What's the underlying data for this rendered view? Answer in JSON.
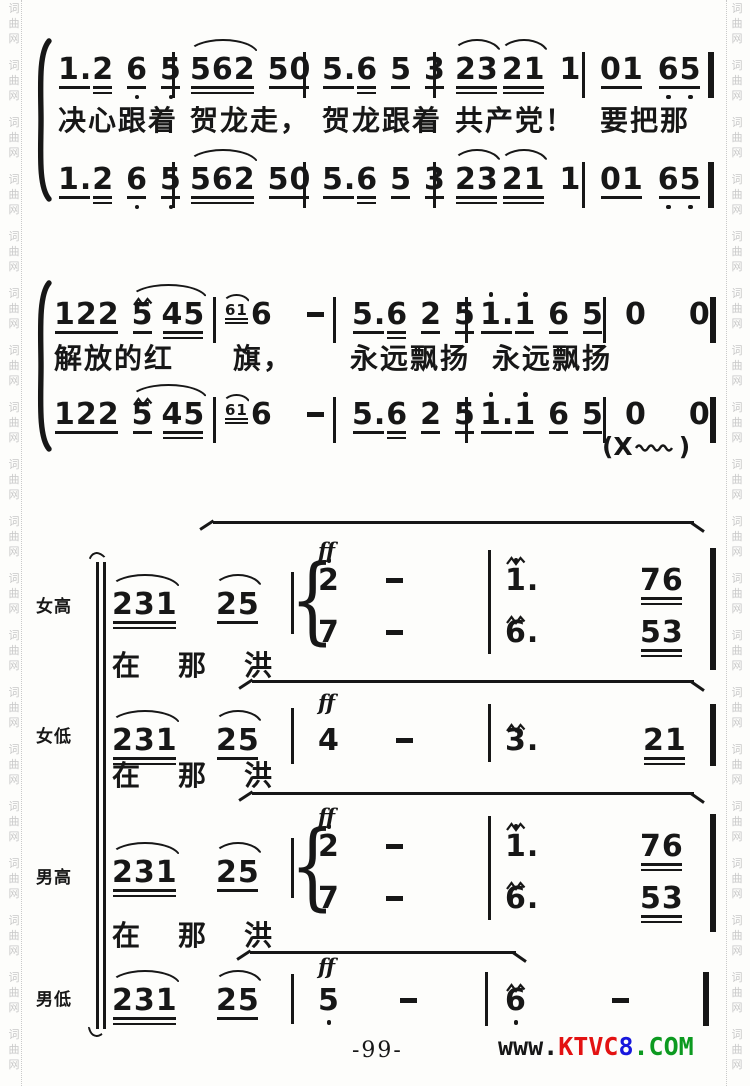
{
  "colors": {
    "ink": "#171717",
    "red": "#e31212",
    "blue": "#1717dd",
    "green": "#0c9a20",
    "watermark": "#c8c8c8"
  },
  "watermark": {
    "chars": [
      "词",
      "曲",
      "网"
    ]
  },
  "page": {
    "number": "-99-"
  },
  "site": {
    "www": "www.",
    "ktvc": "KTVC",
    "eight": "8",
    "com": ".COM"
  },
  "systems": [
    {
      "measures": [
        [
          {
            "t": "1.",
            "u": 1
          },
          {
            "t": "2",
            "u": 2
          },
          {
            "t": "6",
            "u": 1,
            "lo": 1
          },
          {
            "t": "5",
            "u": 1,
            "lo": 1
          }
        ],
        [
          {
            "t": "562",
            "u": 2,
            "arc": 1
          },
          {
            "t": "5 0",
            "u": 1
          }
        ],
        [
          {
            "t": "5.",
            "u": 1
          },
          {
            "t": "6",
            "u": 2
          },
          {
            "t": "5",
            "u": 1
          },
          {
            "t": "3",
            "u": 1
          }
        ],
        [
          {
            "t": "23",
            "u": 2,
            "arc": 1
          },
          {
            "t": "21",
            "u": 2,
            "arc": 1
          },
          {
            "t": "1"
          }
        ],
        [
          {
            "t": "0 1",
            "u": 1
          },
          {
            "t": "6 5",
            "u": 1,
            "lo": 1
          }
        ]
      ],
      "lyrics": [
        "决心跟着",
        "贺龙走，",
        "贺龙跟着",
        "共产党！",
        "要把那"
      ]
    },
    {
      "measures": [
        [
          {
            "t": "1 2 2",
            "u": 1
          },
          {
            "grp": [
              {
                "t": "5",
                "u": 1,
                "mord": 1
              },
              {
                "t": "45",
                "u": 2
              }
            ],
            "arc": 1
          }
        ],
        [
          {
            "t": "6",
            "grace": "61"
          },
          {
            "t": "dash"
          }
        ],
        [
          {
            "t": "5.",
            "u": 1
          },
          {
            "t": "6",
            "u": 2
          },
          {
            "t": "2",
            "u": 1
          },
          {
            "t": "5",
            "u": 1
          }
        ],
        [
          {
            "t": "1.",
            "u": 1,
            "hi": 1
          },
          {
            "t": "1",
            "u": 1,
            "hi": 1
          },
          {
            "t": "6",
            "u": 1
          },
          {
            "t": "5",
            "u": 1
          }
        ],
        [
          {
            "t": "0"
          },
          {
            "t": "0"
          }
        ]
      ],
      "lyrics": [
        "解放的红",
        "旗，",
        "永远飘扬",
        "永远飘扬"
      ],
      "tail": {
        "prefix": "(X",
        "suffix": ")"
      }
    }
  ],
  "choir": {
    "labels": [
      "女高",
      "女低",
      "男高",
      "男低"
    ],
    "dynamic": "ff",
    "m1": [
      {
        "t": "231",
        "u": 2,
        "arc": 1
      },
      {
        "t": "2 5",
        "u": 1,
        "arc": 1
      }
    ],
    "upper": [
      {
        "t": "2",
        "hi": 1
      },
      {
        "t": "dash"
      },
      {
        "t": "1.",
        "hi": 1,
        "mord": 1
      },
      {
        "t": "7 6",
        "u": 2
      }
    ],
    "lower": [
      {
        "t": "7"
      },
      {
        "t": "dash"
      },
      {
        "t": "6.",
        "mord": 1
      },
      {
        "t": "5 3",
        "u": 2
      }
    ],
    "alto": [
      {
        "t": "4"
      },
      {
        "t": "dash"
      },
      {
        "t": "3.",
        "mord": 1
      },
      {
        "t": "2 1",
        "u": 2
      }
    ],
    "bass": [
      {
        "t": "5",
        "lo": 1
      },
      {
        "t": "dash"
      },
      {
        "t": "6",
        "lo": 1,
        "mord": 1
      },
      {
        "t": "dash"
      }
    ],
    "lyrics": [
      "在",
      "那",
      "洪"
    ]
  }
}
